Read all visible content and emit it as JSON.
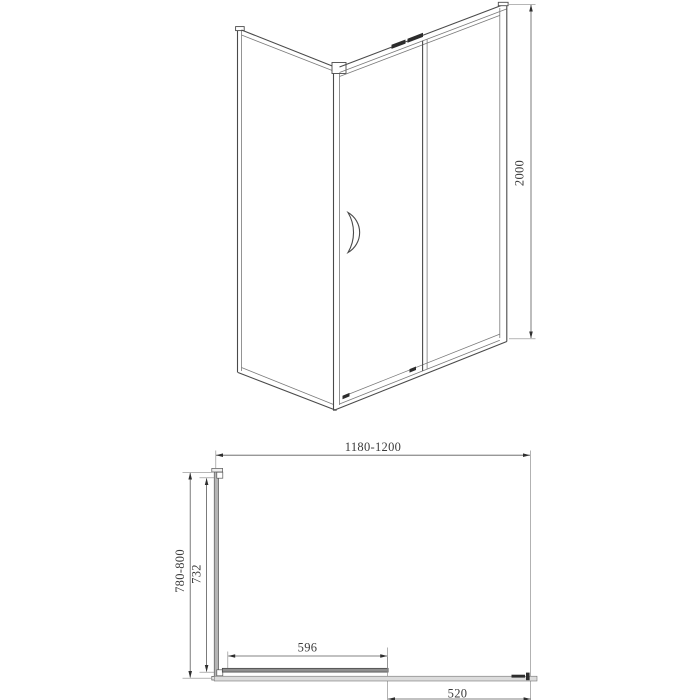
{
  "front_view": {
    "height_label": "2000"
  },
  "plan_view": {
    "width_label": "1180-1200",
    "depth_label": "780-800",
    "glass_width_label": "732",
    "door_width_label": "596",
    "entry_label": "520"
  },
  "colors": {
    "line": "#4a4a4a",
    "dimension": "#5a5a5a",
    "text": "#3c3c3c",
    "panel_fill": "#b5b5b5",
    "track_fill": "#dcdcdc",
    "detail_dark": "#2d2d2d",
    "background": "#ffffff"
  }
}
